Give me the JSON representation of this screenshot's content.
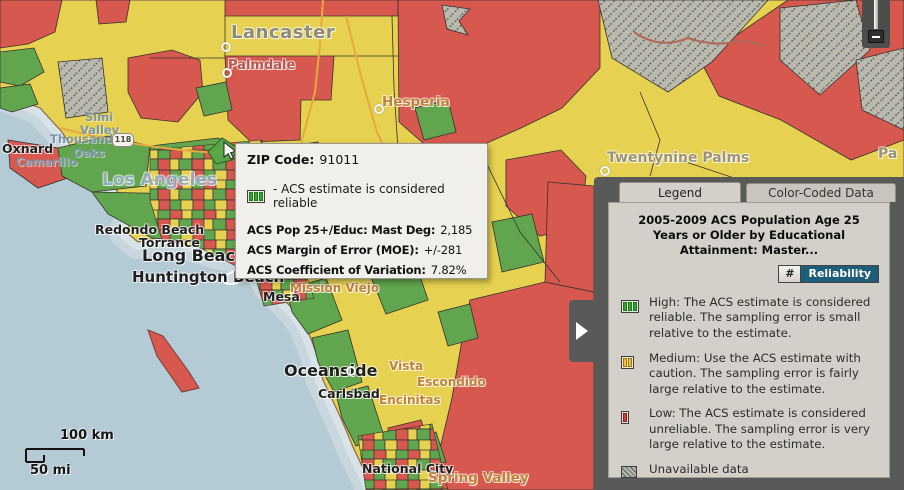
{
  "map": {
    "city_labels": [
      {
        "text": "Lancaster",
        "x": 231,
        "y": 22,
        "cls": "area-gray"
      },
      {
        "text": "Palmdale",
        "x": 228,
        "y": 58,
        "cls": "place-red"
      },
      {
        "text": "Hesperia",
        "x": 382,
        "y": 94,
        "cls": "place-orange-lg"
      },
      {
        "text": "Twentynine Palms",
        "x": 607,
        "y": 150,
        "cls": "area-tan"
      },
      {
        "text": "Oxnard",
        "x": 2,
        "y": 141,
        "cls": "city-md"
      },
      {
        "text": "Camarillo",
        "x": 16,
        "y": 155,
        "cls": "place-blue"
      },
      {
        "text": "Simi",
        "x": 85,
        "y": 110,
        "cls": "place-blue"
      },
      {
        "text": "Valley",
        "x": 80,
        "y": 123,
        "cls": "place-blue"
      },
      {
        "text": "Thousand",
        "x": 50,
        "y": 132,
        "cls": "place-blue"
      },
      {
        "text": "Oaks",
        "x": 73,
        "y": 146,
        "cls": "place-blue"
      },
      {
        "text": "Los Angeles",
        "x": 102,
        "y": 170,
        "cls": "place-blue-xl"
      },
      {
        "text": "Redondo Beach",
        "x": 95,
        "y": 222,
        "cls": "city-md"
      },
      {
        "text": "Torrance",
        "x": 139,
        "y": 235,
        "cls": "city-md"
      },
      {
        "text": "Long Beach",
        "x": 142,
        "y": 246,
        "cls": "city-xl"
      },
      {
        "text": "Huntington Beach",
        "x": 132,
        "y": 268,
        "cls": "city-lg"
      },
      {
        "text": "Mesa",
        "x": 263,
        "y": 289,
        "cls": "city-md"
      },
      {
        "text": "Mission Viejo",
        "x": 290,
        "y": 281,
        "cls": "place-orange"
      },
      {
        "text": "Oceanside",
        "x": 284,
        "y": 361,
        "cls": "city-xl"
      },
      {
        "text": "Carlsbad",
        "x": 318,
        "y": 386,
        "cls": "city-md"
      },
      {
        "text": "Vista",
        "x": 389,
        "y": 359,
        "cls": "place-orange"
      },
      {
        "text": "Escondido",
        "x": 417,
        "y": 375,
        "cls": "place-orange"
      },
      {
        "text": "Encinitas",
        "x": 379,
        "y": 393,
        "cls": "place-orange"
      },
      {
        "text": "National City",
        "x": 362,
        "y": 461,
        "cls": "city-md"
      },
      {
        "text": "Spring Valley",
        "x": 428,
        "y": 470,
        "cls": "place-orange-lg"
      },
      {
        "text": "Pa",
        "x": 878,
        "y": 146,
        "cls": "area-tan"
      }
    ],
    "markers": [
      {
        "x": 221,
        "y": 42
      },
      {
        "x": 222,
        "y": 68
      },
      {
        "x": 374,
        "y": 104
      },
      {
        "x": 600,
        "y": 166
      },
      {
        "x": 346,
        "y": 366
      }
    ],
    "road_shield": "118",
    "scale_bar": {
      "km_label": "100 km",
      "mi_label": "50 mi"
    }
  },
  "popup": {
    "zip_label": "ZIP Code:",
    "zip_value": "91011",
    "reliability_note": "- ACS estimate is considered reliable",
    "rows": [
      {
        "label": "ACS Pop 25+/Educ: Mast Deg:",
        "value": "2,185"
      },
      {
        "label": "ACS Margin of Error (MOE):",
        "value": "+/-281"
      },
      {
        "label": "ACS Coefficient of Variation:",
        "value": "7.82%"
      }
    ]
  },
  "legend_panel": {
    "tabs": [
      {
        "label": "Legend",
        "active": true
      },
      {
        "label": "Color-Coded Data",
        "active": false
      }
    ],
    "title": "2005-2009 ACS Population Age 25 Years or Older by Educational Attainment: Master...",
    "toggle": {
      "hash_label": "#",
      "reliability_label": "Reliability"
    },
    "items": [
      {
        "level": "high",
        "icon": "reliability-high-icon",
        "text": "High: The ACS estimate is considered reliable. The sampling error is small relative to the estimate."
      },
      {
        "level": "medium",
        "icon": "reliability-medium-icon",
        "text": "Medium: Use the ACS estimate with caution. The sampling error is fairly large relative to the estimate."
      },
      {
        "level": "low",
        "icon": "reliability-low-icon",
        "text": "Low: The ACS estimate is considered unreliable. The sampling error is very large relative to the estimate."
      },
      {
        "level": "unavailable",
        "icon": "hatch-icon",
        "text": "Unavailable data"
      }
    ],
    "learn_more": "Learn more..."
  },
  "zoom_control": {
    "zoom_out_icon": "minus-icon"
  },
  "colors": {
    "reliability_high": "#3aa032",
    "reliability_medium": "#efc335",
    "reliability_low": "#cf4038",
    "unavailable_hatch": "#47666c",
    "map_red": "#d6584e",
    "map_yellow": "#e6d150",
    "map_green": "#61a64e",
    "water": "#b4cad4",
    "reliability_button_bg": "#1e5d79",
    "link": "#3c5fb0"
  }
}
